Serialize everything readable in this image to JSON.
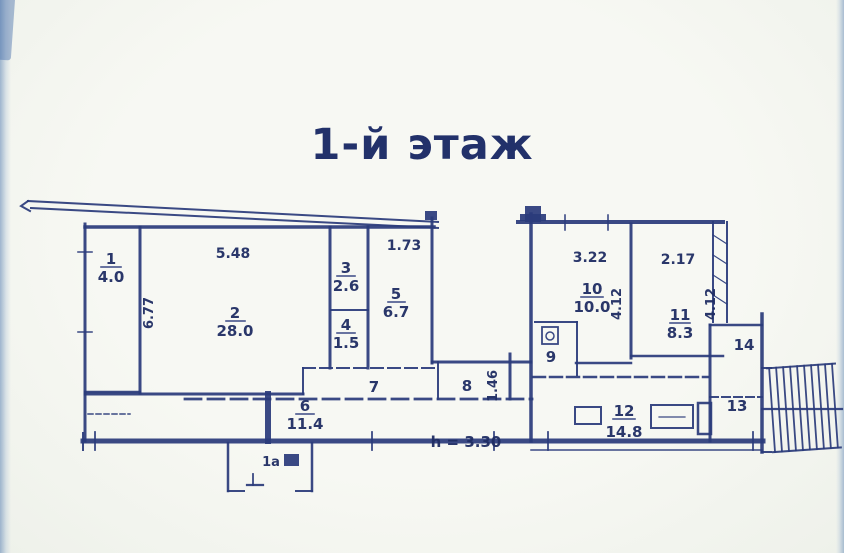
{
  "title": "1-й этаж",
  "plan": {
    "ink_color": "#2b3b7b",
    "rooms": [
      {
        "number": "1",
        "area": "4.0"
      },
      {
        "number": "2",
        "area": "28.0"
      },
      {
        "number": "3",
        "area": "2.6"
      },
      {
        "number": "4",
        "area": "1.5"
      },
      {
        "number": "5",
        "area": "6.7"
      },
      {
        "number": "6",
        "area": "11.4"
      },
      {
        "number": "7"
      },
      {
        "number": "8"
      },
      {
        "number": "9"
      },
      {
        "number": "10",
        "area": "10.0"
      },
      {
        "number": "11",
        "area": "8.3"
      },
      {
        "number": "12",
        "area": "14.8"
      },
      {
        "number": "13"
      },
      {
        "number": "14"
      },
      {
        "number": "1а"
      }
    ],
    "dimensions": {
      "room2_width": "5.48",
      "room2_depth": "6.77",
      "room5_width": "1.73",
      "room8_depth": "1.46",
      "room10_width": "3.22",
      "room10_depth": "4.12",
      "room11_width": "2.17",
      "room11_depth": "4.12",
      "ceiling_height": "h = 3.30"
    }
  }
}
